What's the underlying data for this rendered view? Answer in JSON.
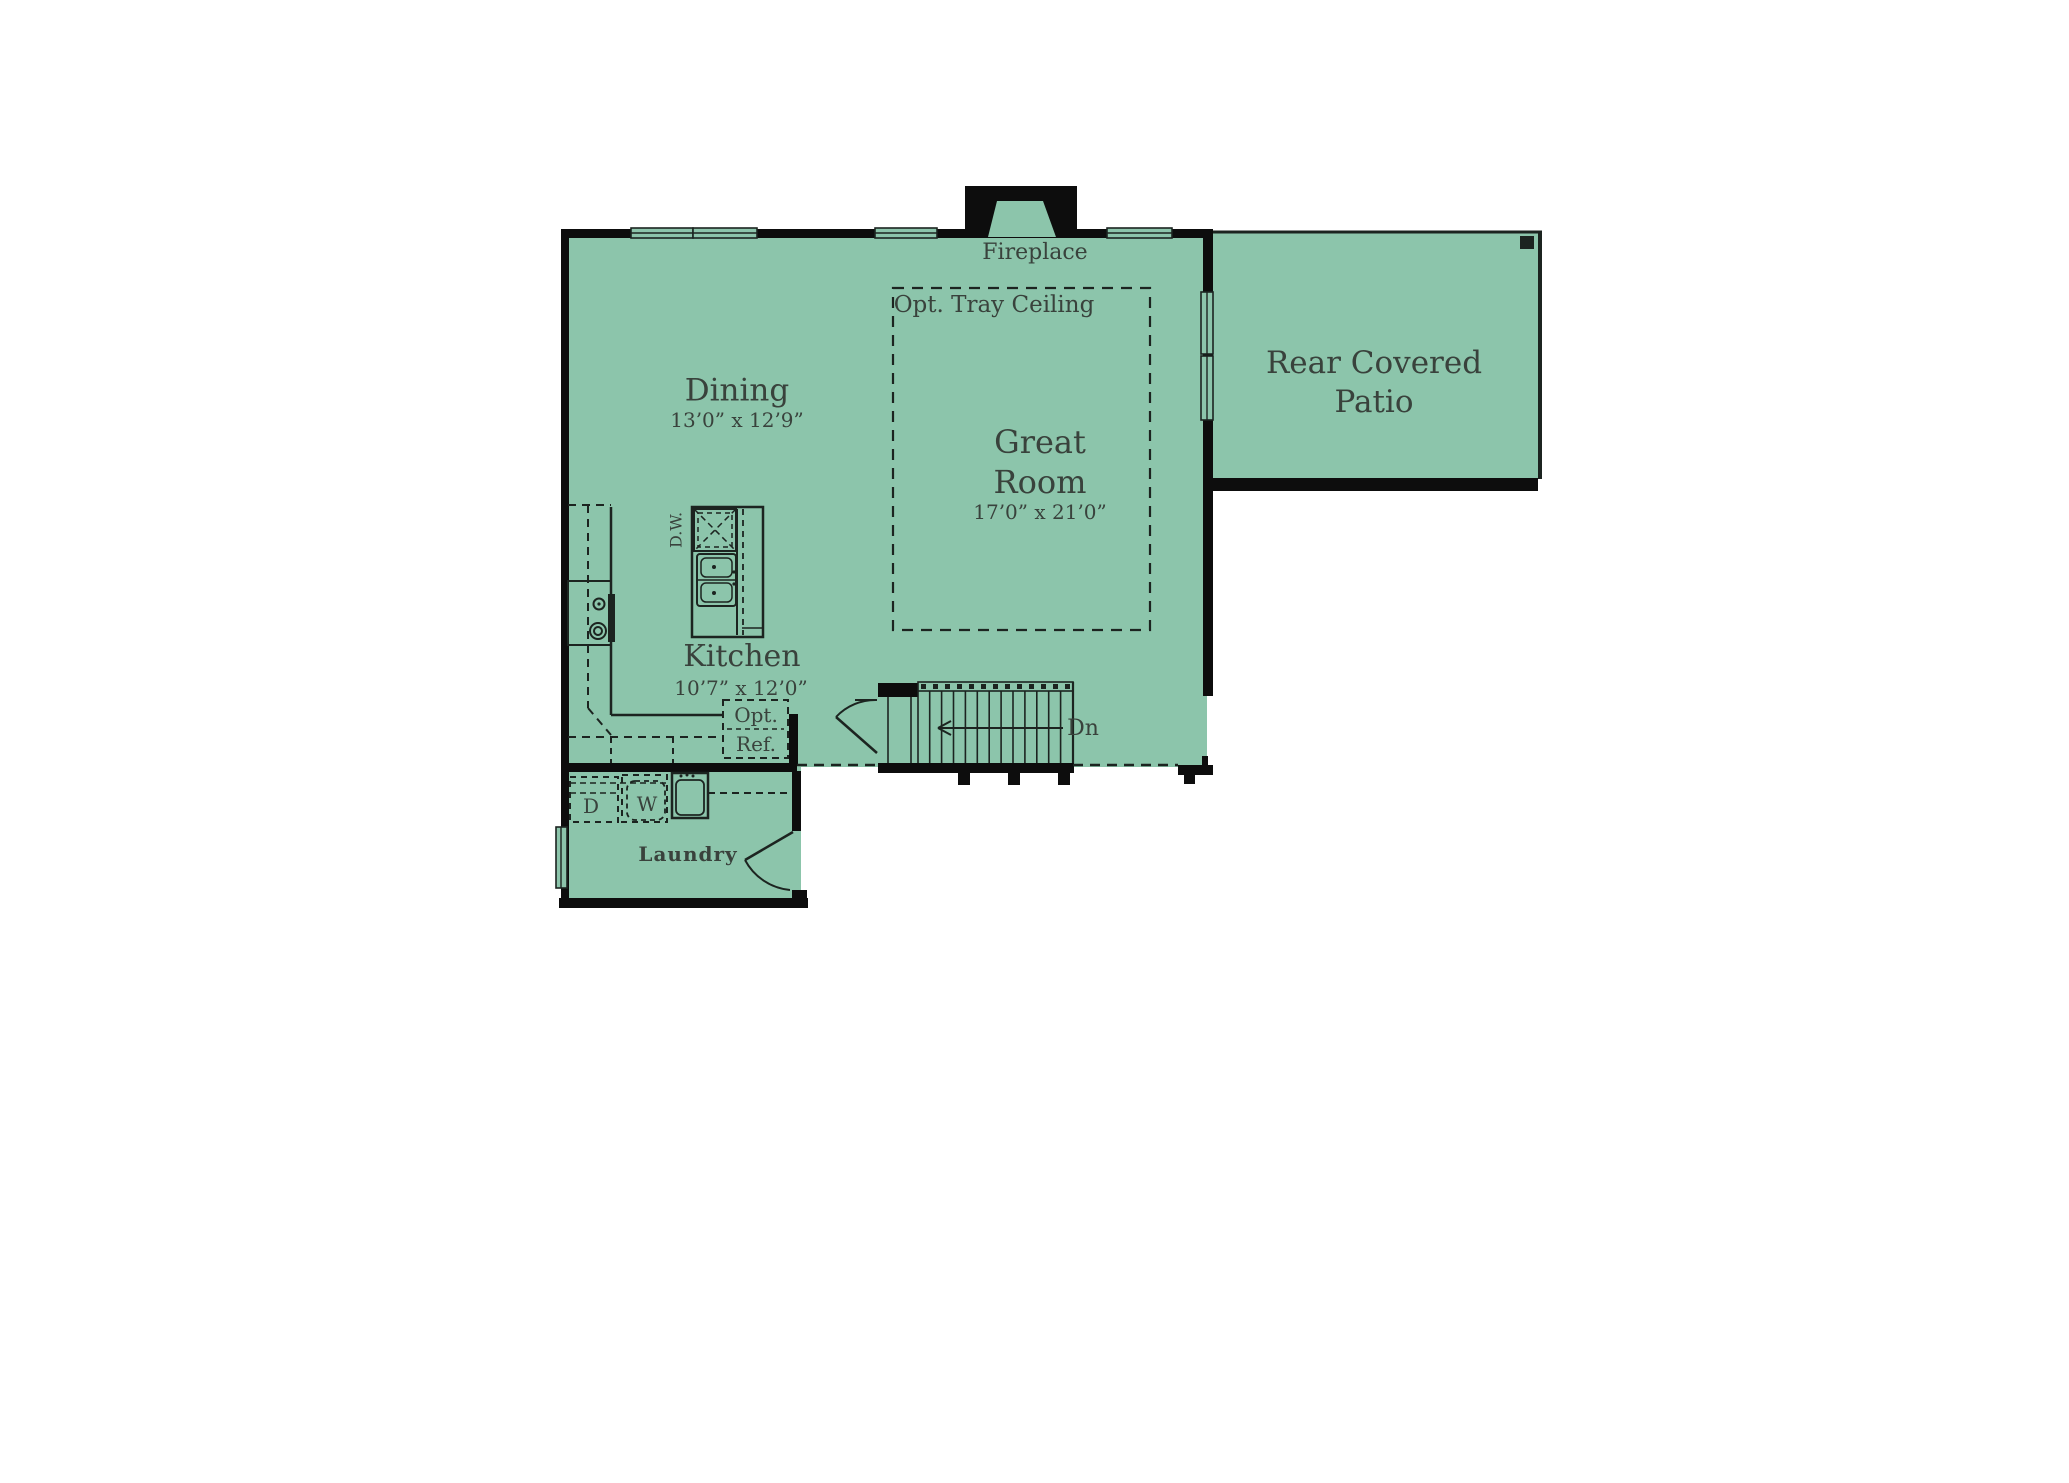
{
  "palette": {
    "floor_green": "#8cc5ab",
    "wall_black": "#0d0d0d",
    "line_dark": "#1c2420",
    "text_dark": "#39423c",
    "background": "#ffffff"
  },
  "rooms": {
    "dining": {
      "name": "Dining",
      "dims": "13’0” x 12’9”"
    },
    "great_room": {
      "line1": "Great",
      "line2": "Room",
      "dims": "17’0” x 21’0”"
    },
    "kitchen": {
      "name": "Kitchen",
      "dims": "10’7” x 12’0”"
    },
    "laundry": {
      "name": "Laundry"
    },
    "patio": {
      "line1": "Rear Covered",
      "line2": "Patio"
    }
  },
  "labels": {
    "fireplace": "Fireplace",
    "tray_ceiling": "Opt. Tray Ceiling",
    "stairs_down": "Dn",
    "dishwasher": "D.W.",
    "opt_ref": "Opt.\nRef.",
    "dryer": "D",
    "washer": "W"
  }
}
